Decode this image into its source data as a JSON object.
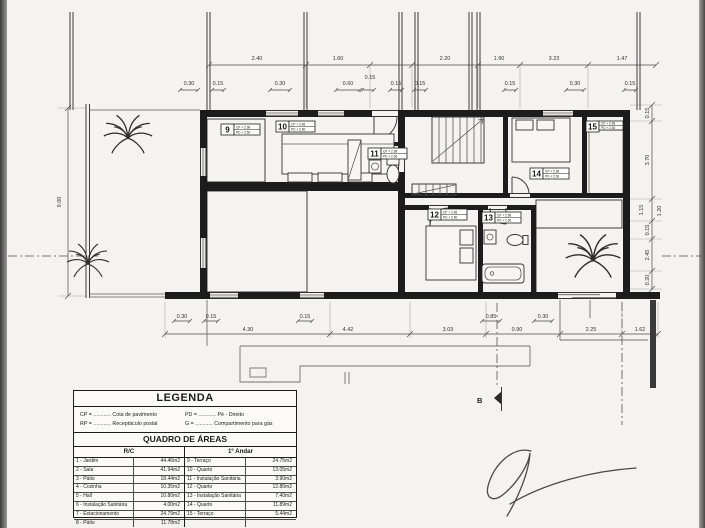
{
  "plan": {
    "section_marker": "B",
    "dim_left": "9.00",
    "dims_top_major": [
      "2.40",
      "1.60",
      "2.20",
      "1.90",
      "3.23",
      "1.47"
    ],
    "dims_top_minor": [
      "0.30",
      "0.15",
      "0.30",
      "0.60",
      "0.15",
      "0.15",
      "0.15",
      "0.15",
      "0.30",
      "0.15"
    ],
    "dims_right": [
      "0.15",
      "3.70",
      "1.15",
      "1.20",
      "0.15",
      "2.45",
      "0.20"
    ],
    "dims_bottom_major": [
      "4.30",
      "4.42",
      "3.03",
      "0.90",
      "2.25",
      "1.62"
    ],
    "dims_bottom_minor": [
      "0.30",
      "0.15",
      "0.15",
      "0.85",
      "0.30"
    ],
    "rooms": [
      {
        "number": "9",
        "cp": "CP + 2.98",
        "pd": "PD + 2.60"
      },
      {
        "number": "10",
        "cp": "CP + 2.98",
        "pd": "PD + 2.60"
      },
      {
        "number": "11",
        "cp": "CP + 2.98",
        "pd": "PD + 2.60"
      },
      {
        "number": "12",
        "cp": "CP + 2.98",
        "pd": "PD + 2.60"
      },
      {
        "number": "13",
        "cp": "CP + 2.98",
        "pd": "PD + 2.60"
      },
      {
        "number": "14",
        "cp": "CP + 2.98",
        "pd": "PD + 2.60"
      },
      {
        "number": "15",
        "cp": "CP + 2.98",
        "pd": "PD + 2.60"
      }
    ]
  },
  "legend": {
    "title": "LEGENDA",
    "entries": [
      "CP = ............ Cota de pavimento",
      "PD = ............ Pé - Direito",
      "RP = ............ Receptáculo postal",
      "G  = ............ Compartimento para gás"
    ]
  },
  "areas": {
    "title": "QUADRO DE ÁREAS",
    "left_header": "R/C",
    "right_header": "1º Andar",
    "left_rows": [
      [
        "1 - Jardim",
        "44.46m2"
      ],
      [
        "2 - Sala",
        "41.94m2"
      ],
      [
        "3 - Pátio",
        "18.44m2"
      ],
      [
        "4 - Cozinha",
        "10.35m2"
      ],
      [
        "5 - Hall",
        "10.80m2"
      ],
      [
        "6 - Instalação Sanitária",
        "4.00m2"
      ],
      [
        "7 - Estacionamento",
        "24.79m2"
      ],
      [
        "8 - Pátio",
        "11.78m2"
      ]
    ],
    "right_rows": [
      [
        "9 - Terraço",
        "24.75m2"
      ],
      [
        "10 - Quarto",
        "13.05m2"
      ],
      [
        "11 - Instalação Sanitária",
        "3.90m2"
      ],
      [
        "12 - Quarto",
        "12.86m2"
      ],
      [
        "13 - Instalação Sanitária",
        "7.40m2"
      ],
      [
        "14 - Quarto",
        "11.89m2"
      ],
      [
        "15 - Terraço",
        "5.44m2"
      ],
      [
        "",
        ""
      ]
    ]
  }
}
